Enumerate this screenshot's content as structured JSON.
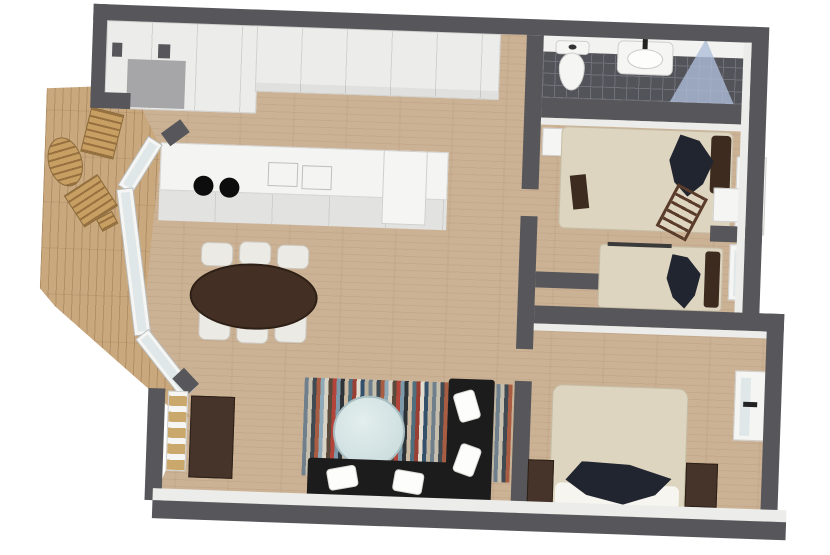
{
  "meta": {
    "title": "3D apartment floor plan, top-down render",
    "style": "photoreal 3D floorplan on white background",
    "no_visible_text": true
  },
  "palette": {
    "white": "#ffffff",
    "wall": "#57575b",
    "wallface": "#ececea",
    "wood": "#ccb295",
    "deck": "#c9a87e",
    "cabinet": "#ececea",
    "seam": "#d2d2d0",
    "counter": "#f4f4f2",
    "counterfront": "#e2e2e0",
    "tile": "#53535a",
    "grout": "#70707a",
    "glass": "#dfe7e9",
    "frame": "#f5f5f3",
    "shower": "#aebdd8",
    "linen": "#ded5c0",
    "sheet": "#f7f5ef",
    "navy": "#21252f",
    "brownpillow": "#3d2b20",
    "darkwood": "#46342a",
    "sofa": "#1c1c1c",
    "pillow": "#fdfdfb",
    "table": "#432f23",
    "chair": "#eceae4",
    "entryfloor": "#a6a6a8"
  },
  "rug_stripes": [
    "#6f7f8c",
    "#c7bfae",
    "#3f4a52",
    "#a85c41",
    "#8fa9b8",
    "#d9d3c5",
    "#5a4a3c",
    "#b3443a",
    "#7d98a8",
    "#2e3338",
    "#cbb9a2",
    "#4f6e7e",
    "#9a3f33",
    "#e2ddd1",
    "#35506b",
    "#bfb4a0"
  ],
  "rooms": [
    {
      "name": "deck",
      "furniture": [
        "lounge chair",
        "patio table",
        "lounge chair",
        "stool"
      ]
    },
    {
      "name": "entry",
      "furniture": [
        "closet",
        "entry floor mat"
      ]
    },
    {
      "name": "kitchen",
      "furniture": [
        "wardrobe cabinets",
        "counter",
        "cooktop burners",
        "sink",
        "tall cabinet"
      ]
    },
    {
      "name": "dining area",
      "furniture": [
        "oval dining table",
        "6 white chairs"
      ]
    },
    {
      "name": "living room",
      "furniture": [
        "striped rug",
        "round glass table",
        "black sofa",
        "black sofa",
        "white cushions",
        "sideboard",
        "shelf unit"
      ]
    },
    {
      "name": "bathroom",
      "furniture": [
        "toilet",
        "sink vanity",
        "glass shower"
      ]
    },
    {
      "name": "bedroom 1",
      "furniture": [
        "bed",
        "ladder",
        "dresser",
        "window unit"
      ]
    },
    {
      "name": "bedroom 2",
      "furniture": [
        "bed",
        "dresser",
        "window unit"
      ]
    },
    {
      "name": "master bedroom",
      "furniture": [
        "double bed",
        "nightstand",
        "nightstand",
        "window unit"
      ]
    }
  ]
}
